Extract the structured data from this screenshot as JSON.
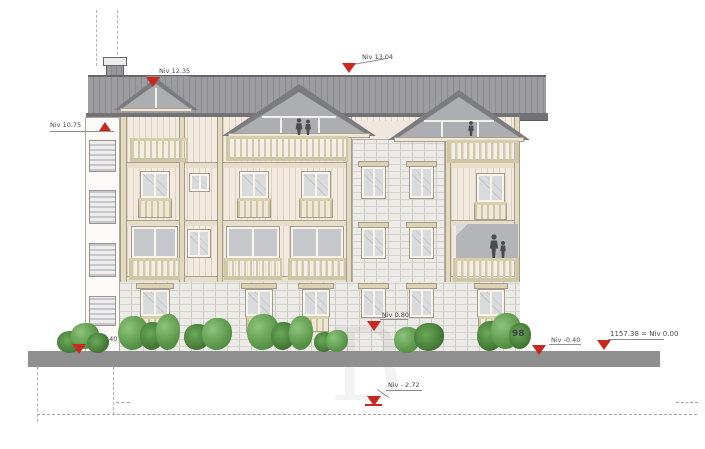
{
  "drawing": {
    "type": "architectural elevation",
    "watermark_letter": "B",
    "annotations": {
      "small_gable": {
        "label": "Niv 12.35"
      },
      "ridge": {
        "label": "Niv 13.04"
      },
      "eave_left": {
        "label": "Niv 10.75"
      },
      "ground_left": {
        "label": "Niv -0.40"
      },
      "stone_mid": {
        "label": "Niv 0.80"
      },
      "bold_ref": {
        "label": "98"
      },
      "ground_right": {
        "label": "Niv -0.40"
      },
      "datum": {
        "label": "1157.38 = Niv 0.00"
      },
      "basement": {
        "label": "Niv - 2.72"
      }
    },
    "colors": {
      "roof": "#9d9da1",
      "roof_fascia": "#737377",
      "wall_cream": "#f2e9df",
      "trim": "#d8cfae",
      "stone": "#edebe7",
      "glass": "#d9dadc",
      "gable_glass": "#adaeb2",
      "ground": "#8f8f8f",
      "plant_green": "#5d9a4c",
      "marker_red": "#c9281e",
      "text_gray": "#4a4a4e"
    }
  }
}
